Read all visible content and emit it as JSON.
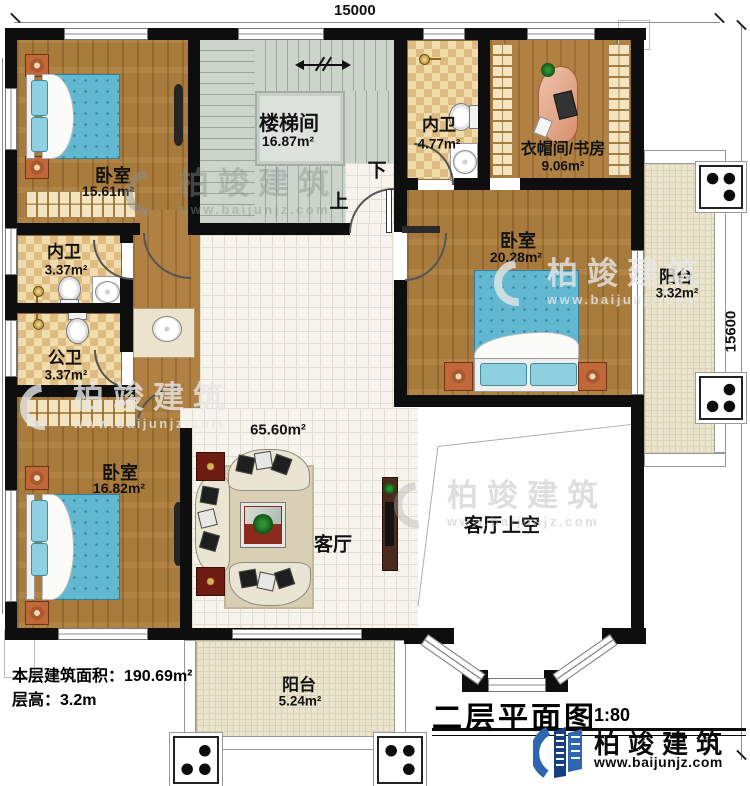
{
  "dimensions": {
    "top": "15000",
    "right": "15600"
  },
  "rooms": {
    "stairwell": {
      "name": "楼梯间",
      "area": "16.87m²"
    },
    "bath_top": {
      "name": "内卫",
      "area": "4.77m²"
    },
    "cloak_study": {
      "name": "衣帽间/书房",
      "area": "9.06m²"
    },
    "bedroom_tl": {
      "name": "卧室",
      "area": "15.61m²"
    },
    "bath_mid": {
      "name": "内卫",
      "area": "3.37m²"
    },
    "bath_public": {
      "name": "公卫",
      "area": "3.37m²"
    },
    "bedroom_r": {
      "name": "卧室",
      "area": "20.28m²"
    },
    "balcony_r": {
      "name": "阳台",
      "area": "3.32m²"
    },
    "bedroom_bl": {
      "name": "卧室",
      "area": "16.82m²"
    },
    "living": {
      "name": "客厅",
      "area": "65.60m²"
    },
    "living_void": {
      "name": "客厅上空"
    },
    "balcony_b": {
      "name": "阳台",
      "area": "5.24m²"
    }
  },
  "stairs": {
    "up": "上",
    "down": "下"
  },
  "info": {
    "floor_area": "本层建筑面积：190.69m²",
    "floor_height": "层高：3.2m"
  },
  "title": {
    "text": "二层平面图",
    "scale": "1:80"
  },
  "brand": {
    "name": "柏竣建筑",
    "url": "www.baijunjz.com"
  },
  "watermark": {
    "name": "柏竣建筑",
    "url": "www.baijunjz.com"
  },
  "colors": {
    "wall": "#0e0e0e",
    "wood": "#a87a3c",
    "bed": "#63b8d1",
    "brand_blue": "#2f66b1",
    "stair": "#ccd4cb"
  }
}
